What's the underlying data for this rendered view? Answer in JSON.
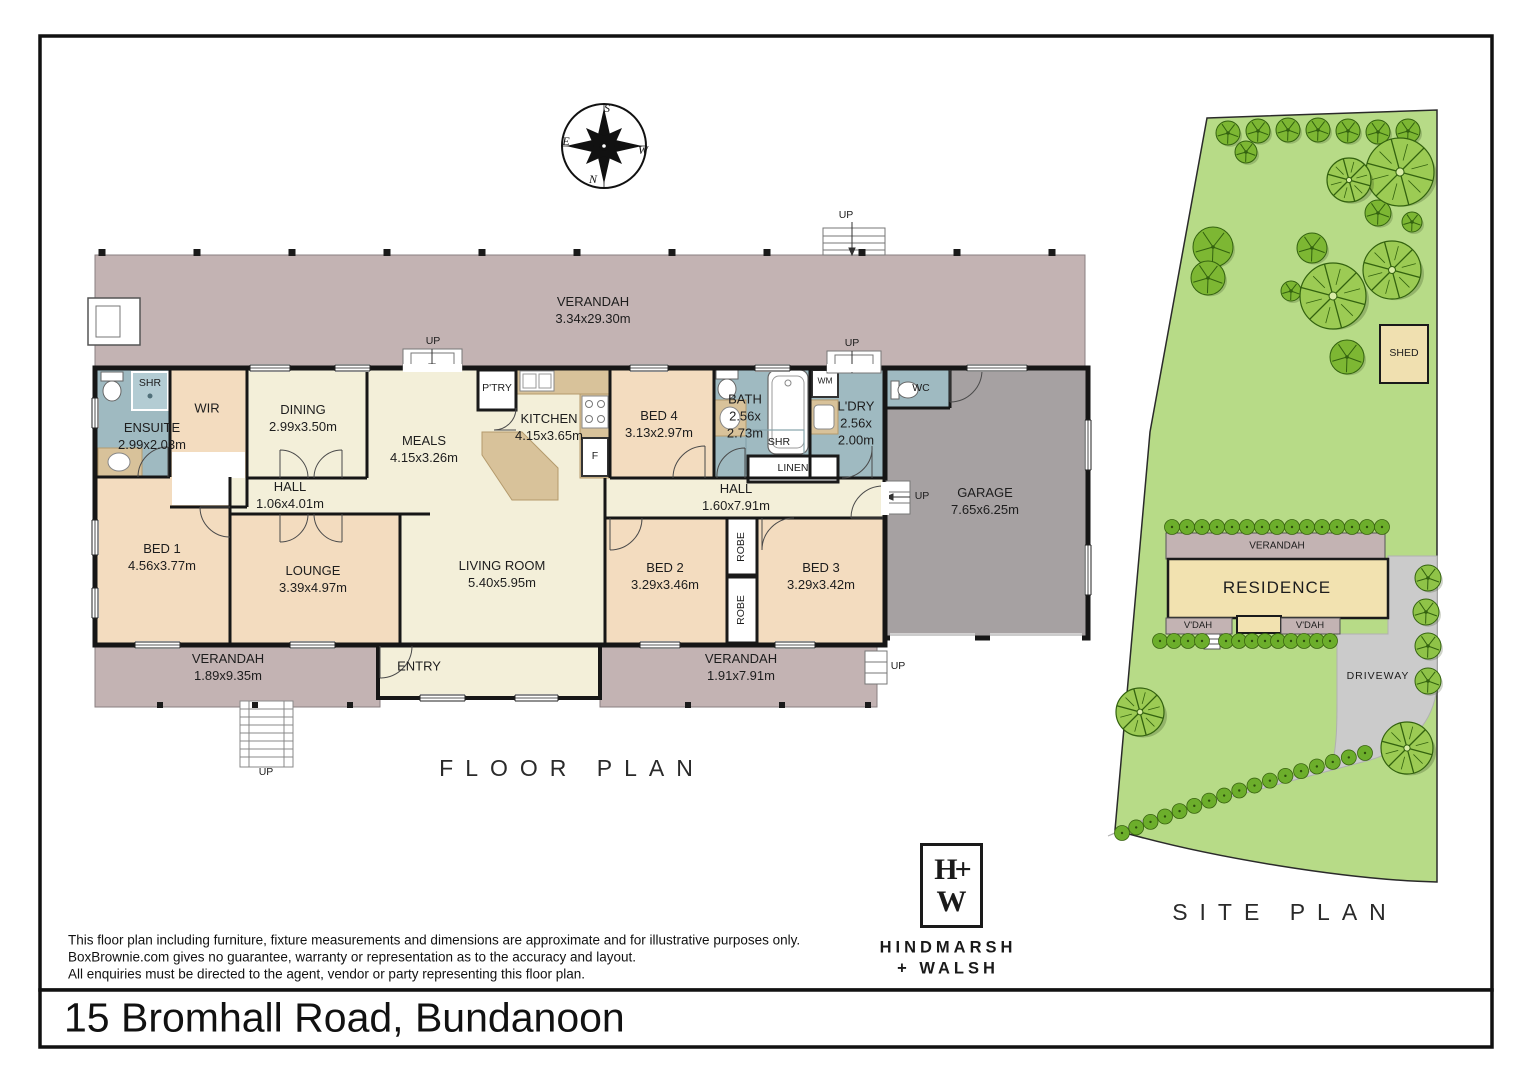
{
  "address": "15 Bromhall Road, Bundanoon",
  "disclaimer": {
    "line1": "This floor plan including furniture, fixture measurements and dimensions are approximate and for illustrative purposes only.",
    "line2": "BoxBrownie.com gives no guarantee, warranty or representation as to the accuracy and layout.",
    "line3": "All enquiries must be directed to the agent, vendor or party representing this floor plan."
  },
  "compass": {
    "top": "S",
    "left": "E",
    "right": "W",
    "bottom": "N"
  },
  "floor_plan": {
    "title": "FLOOR PLAN",
    "up": "UP",
    "rooms": {
      "verandah_top": {
        "name": "VERANDAH",
        "dims": "3.34x29.30m"
      },
      "ensuite": {
        "name": "ENSUITE",
        "dims": "2.99x2.03m"
      },
      "shr1": {
        "name": "SHR"
      },
      "wir": {
        "name": "WIR"
      },
      "dining": {
        "name": "DINING",
        "dims": "2.99x3.50m"
      },
      "meals": {
        "name": "MEALS",
        "dims": "4.15x3.26m"
      },
      "ptry": {
        "name": "P'TRY"
      },
      "kitchen": {
        "name": "KITCHEN",
        "dims": "4.15x3.65m"
      },
      "fridge": {
        "name": "F"
      },
      "bed4": {
        "name": "BED 4",
        "dims": "3.13x2.97m"
      },
      "bath": {
        "name": "BATH",
        "dims1": "2.56x",
        "dims2": "2.73m"
      },
      "shr2": {
        "name": "SHR"
      },
      "wm": {
        "name": "WM"
      },
      "ldry": {
        "name": "L'DRY",
        "dims1": "2.56x",
        "dims2": "2.00m"
      },
      "linen": {
        "name": "LINEN"
      },
      "wc": {
        "name": "WC"
      },
      "hall1": {
        "name": "HALL",
        "dims": "1.06x4.01m"
      },
      "hall2": {
        "name": "HALL",
        "dims": "1.60x7.91m"
      },
      "garage": {
        "name": "GARAGE",
        "dims": "7.65x6.25m"
      },
      "bed1": {
        "name": "BED 1",
        "dims": "4.56x3.77m"
      },
      "lounge": {
        "name": "LOUNGE",
        "dims": "3.39x4.97m"
      },
      "living": {
        "name": "LIVING ROOM",
        "dims": "5.40x5.95m"
      },
      "bed2": {
        "name": "BED 2",
        "dims": "3.29x3.46m"
      },
      "robe": {
        "name": "ROBE"
      },
      "bed3": {
        "name": "BED 3",
        "dims": "3.29x3.42m"
      },
      "verandah_bl": {
        "name": "VERANDAH",
        "dims": "1.89x9.35m"
      },
      "entry": {
        "name": "ENTRY"
      },
      "verandah_br": {
        "name": "VERANDAH",
        "dims": "1.91x7.91m"
      }
    }
  },
  "site_plan": {
    "title": "SITE PLAN",
    "shed": "SHED",
    "verandah": "VERANDAH",
    "residence": "RESIDENCE",
    "vdah": "V'DAH",
    "driveway": "DRIVEWAY"
  },
  "logo": {
    "monogram_line1": "H+",
    "monogram_line2": "W",
    "name_line1": "HINDMARSH",
    "name_line2": "+ WALSH"
  },
  "colors": {
    "verandah": "#c3b3b3",
    "floor_cream": "#f3efd9",
    "floor_peach": "#f3dcbf",
    "bath_blue": "#9fbac1",
    "garage_gray": "#a6a1a2",
    "bench_tan": "#d8c29a",
    "wall": "#161616",
    "site_green": "#b7db87",
    "tree_light": "#9ccb54",
    "tree_mid": "#7db733",
    "tree_dark": "#33620f",
    "hedge": "#6cae2b",
    "driveway": "#cbcbcb",
    "residence": "#f2e2b0",
    "shed": "#f0e0b0"
  }
}
